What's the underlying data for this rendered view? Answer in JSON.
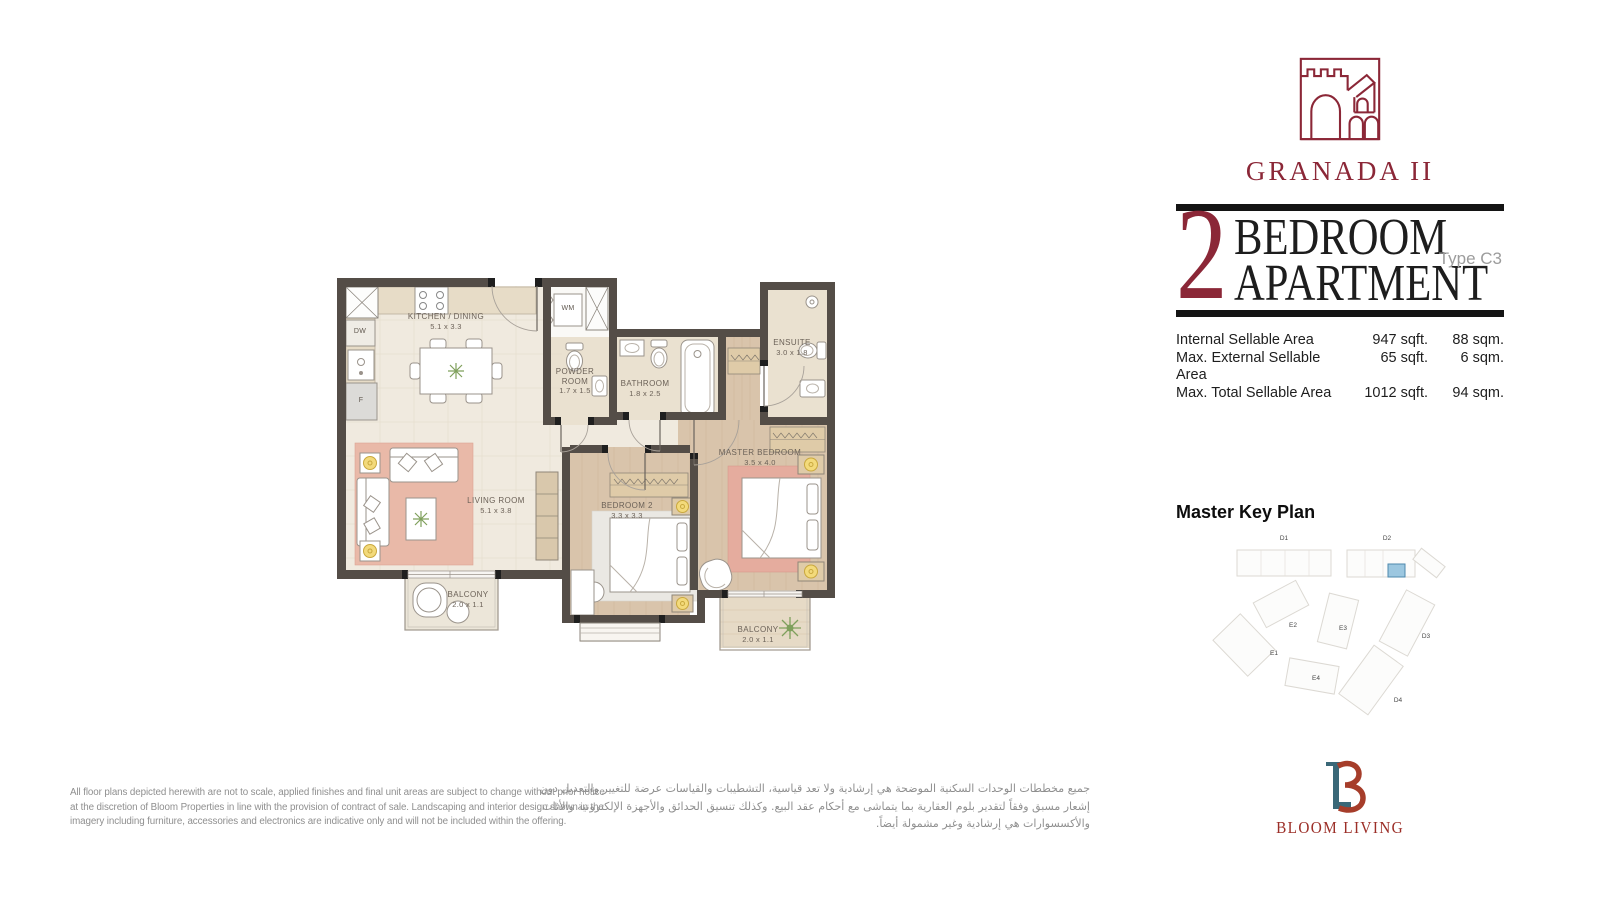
{
  "brand": {
    "project_name": "GRANADA II",
    "wordmark": "BLOOM LIVING",
    "icons": {
      "project_logo": "castle-logo",
      "developer_logo": "bloom-lb-monogram"
    }
  },
  "title_block": {
    "number": "2",
    "line1": "BEDROOM",
    "line2": "APARTMENT",
    "unit_type": "Type C3"
  },
  "areas": {
    "rows": [
      {
        "label": "Internal Sellable Area",
        "sqft": "947 sqft.",
        "sqm": "88 sqm."
      },
      {
        "label": "Max. External Sellable Area",
        "sqft": "65 sqft.",
        "sqm": "6 sqm."
      },
      {
        "label": "Max. Total Sellable Area",
        "sqft": "1012 sqft.",
        "sqm": "94 sqm."
      }
    ]
  },
  "keyplan": {
    "heading": "Master Key Plan",
    "buildings": [
      "D1",
      "D2",
      "E2",
      "E3",
      "D3",
      "E1",
      "E4",
      "D4"
    ],
    "highlight_color": "#9CC7E0"
  },
  "floorplan": {
    "rooms": {
      "kitchen": {
        "name": "KITCHEN / DINING",
        "dims": "5.1 x 3.3"
      },
      "powder": {
        "name": "POWDER ROOM",
        "dims": "1.7 x 1.5"
      },
      "bathroom": {
        "name": "BATHROOM",
        "dims": "1.8 x 2.5"
      },
      "ensuite": {
        "name": "ENSUITE",
        "dims": "3.0 x 1.8"
      },
      "master": {
        "name": "MASTER BEDROOM",
        "dims": "3.5 x 4.0"
      },
      "bedroom2": {
        "name": "BEDROOM 2",
        "dims": "3.3 x 3.3"
      },
      "living": {
        "name": "LIVING ROOM",
        "dims": "5.1 x 3.8"
      },
      "balcony_left": {
        "name": "BALCONY",
        "dims": "2.0 x 1.1"
      },
      "balcony_right": {
        "name": "BALCONY",
        "dims": "2.0 x 1.1"
      }
    },
    "fixtures": {
      "dw": "DW",
      "f": "F",
      "wm": "WM"
    }
  },
  "disclaimer_en": {
    "lines": [
      "All floor plans depicted herewith are not to scale, applied finishes and final unit areas are subject to change without prior notice",
      "at the discretion of Bloom Properties in line with the provision of contract of sale. Landscaping and interior design shown in the",
      "imagery including furniture, accessories and electronics are indicative only and will not be included within the offering."
    ]
  },
  "disclaimer_ar": {
    "lines": [
      "جميع مخططات الوحدات السكنية الموضحة هي إرشادية ولا تعد قياسية، التشطيبات والقياسات عرضة للتغيير والتعديل دون",
      "إشعار مسبق وفقاً لتقدير بلوم العقارية بما يتماشى مع أحكام عقد البيع. وكذلك تنسيق الحدائق والأجهزة الإلكترونية والأثاث",
      "والأكسسوارات هي إرشادية وغير مشمولة أيضاً."
    ]
  },
  "colors": {
    "brand_maroon": "#8B2737",
    "bloom_red": "#A63D2A",
    "bloom_teal": "#3A6878",
    "wall": "#544D47",
    "keyplan_highlight": "#9CC7E0"
  }
}
